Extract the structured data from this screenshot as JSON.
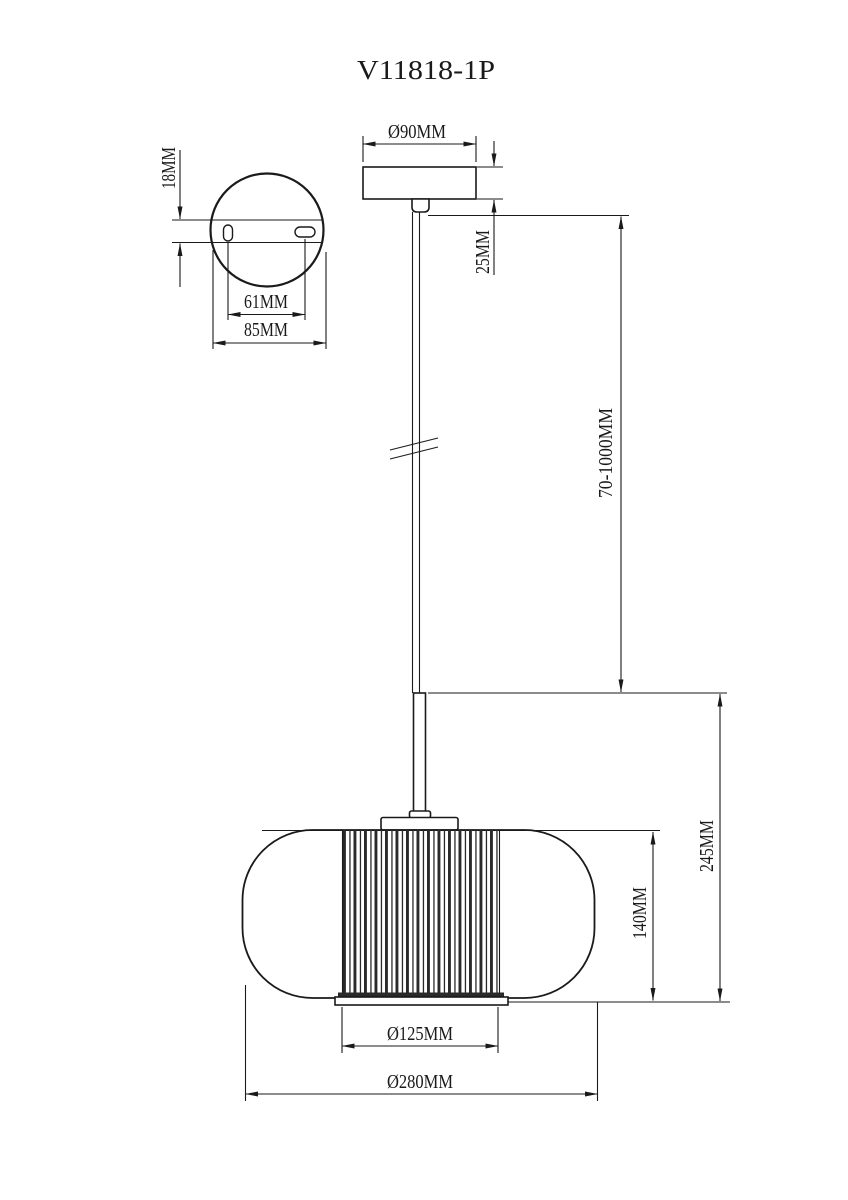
{
  "title": "V11818-1P",
  "colors": {
    "line": "#1a1a1a",
    "background": "#ffffff"
  },
  "detail_view": {
    "plate_thickness": "18MM",
    "hole_spacing": "61MM",
    "plate_width": "85MM"
  },
  "canopy": {
    "diameter": "Ø90MM",
    "height": "25MM"
  },
  "rod": {
    "length_range": "70-1000MM"
  },
  "shade": {
    "overall_height": "245MM",
    "diffuser_height": "140MM",
    "diffuser_diameter": "Ø125MM",
    "shade_diameter": "Ø280MM"
  }
}
